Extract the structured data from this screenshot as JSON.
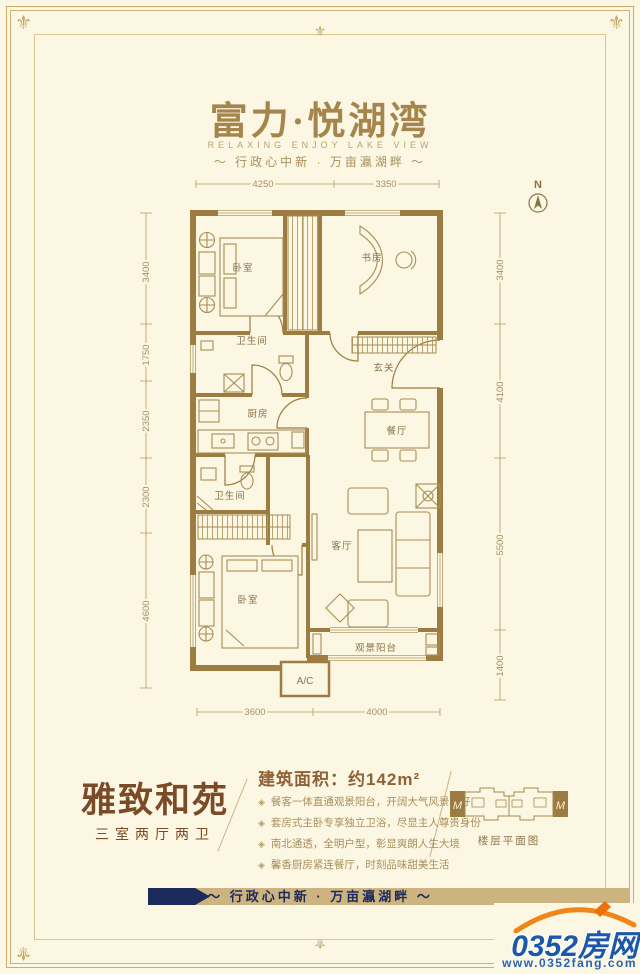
{
  "icons": {
    "fleur": "⚜"
  },
  "colors": {
    "background": "#FBF7E3",
    "frame_gold": "#C9AD6E",
    "wall_brown": "#9C7C40",
    "line_gold": "#B49A62",
    "navy": "#1C2A5C",
    "band_tan": "#CDB37F",
    "logo_blue": "#1D57A8",
    "logo_orange": "#F08519",
    "name_brown": "#7B4A26"
  },
  "header": {
    "title": "富力·悦湖湾",
    "subtitle_en": "RELAXING ENJOY LAKE VIEW",
    "subtitle_cn": "～ 行政心中新 · 万亩瀛湖畔 ～"
  },
  "compass": {
    "label": "N"
  },
  "floorplan": {
    "rooms": [
      {
        "label": "卧室"
      },
      {
        "label": "书房"
      },
      {
        "label": "卫生间"
      },
      {
        "label": "玄关"
      },
      {
        "label": "厨房"
      },
      {
        "label": "餐厅"
      },
      {
        "label": "卫生间"
      },
      {
        "label": "客厅"
      },
      {
        "label": "卧室"
      },
      {
        "label": "观景阳台"
      },
      {
        "label": "A/C"
      }
    ],
    "dims": {
      "top": [
        "4250",
        "3350"
      ],
      "bottom": [
        "3600",
        "4000"
      ],
      "left": [
        "3400",
        "1750",
        "2350",
        "2300",
        "4600"
      ],
      "right": [
        "3400",
        "4100",
        "5500",
        "1400"
      ]
    }
  },
  "info": {
    "name": "雅致和苑",
    "layout": "三室两厅两卫",
    "area_label": "建筑面积：约142m²",
    "marker": "◈",
    "features": [
      "餐客一体直通观景阳台，开阔大气风景独好",
      "套房式主卧专享独立卫浴，尽显主人尊贵身份",
      "南北通透，全明户型，彰显爽朗人生大境",
      "馨香厨房紧连餐厅，时刻品味甜美生活"
    ],
    "diagram_label": "楼层平面图",
    "diagram_marks": [
      "M",
      "M"
    ]
  },
  "banner": {
    "text": "～ 行政心中新 · 万亩瀛湖畔 ～"
  },
  "logo": {
    "name": "0352房网",
    "url": "www.0352fang.com"
  }
}
